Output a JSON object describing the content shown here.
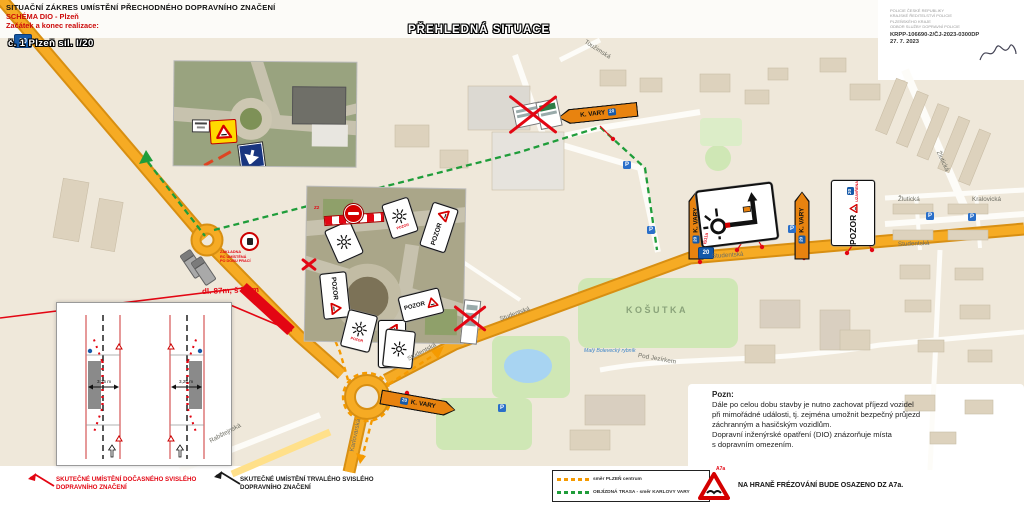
{
  "header": {
    "line1": "SITUAČNÍ ZÁKRES UMÍSTĚNÍ PŘECHODNÉHO DOPRAVNÍHO ZNAČENÍ",
    "line2": "SCHÉMA DIO - Plzeň",
    "line3": "Začátek a konec realizace:",
    "badge": "č. 1 Plzeň sil. I/20"
  },
  "title": "PŘEHLEDNÁ SITUACE",
  "stamp": {
    "l1": "POLICIE ČESKÉ REPUBLIKY",
    "l2": "KRAJSKÉ ŘEDITELSTVÍ POLICIE",
    "l3": "PLZEŇSKÉHO KRAJE",
    "l4": "ODBOR SLUŽBY DOPRAVNÍ POLICIE",
    "ref": "KRPP-106690-2/ČJ-2023-0300DP",
    "date": "27. 7. 2023"
  },
  "note": {
    "title": "Pozn:",
    "line1": "Dále po celou dobu stavby je nutno zachovat příjezd vozidel",
    "line2": "při mimořádné události, tj. zejména umožnit bezpečný průjezd",
    "line3": "záchranným a hasičským vozidlům.",
    "line4": "Dopravní inženýrské opatření (DIO) znázorňuje místa",
    "line5": "s dopravním omezením."
  },
  "legend": {
    "temp_sign": "SKUTEČNÉ UMÍSTĚNÍ DOČASNÉHO SVISLÉHO DOPRAVNÍHO ZNAČENÍ",
    "perm_sign": "SKUTEČNÉ UMÍSTĚNÍ TRVALÉHO SVISLÉHO DOPRAVNÍHO ZNAČENÍ",
    "route_center": "směr PLZEŇ centrum",
    "route_detour": "OBJÍZDNÁ TRASA - směr KARLOVY VARY",
    "a7a_label": "A7a",
    "a7a_text": "NA HRANĚ FRÉZOVÁNÍ BUDE OSAZENO DZ A7a.",
    "colors": {
      "temp": "#e30613",
      "perm": "#1a1a1a",
      "center_route": "#f59a00",
      "detour_route": "#1f9d3a"
    }
  },
  "map": {
    "district": "KOŠUTKA",
    "lake": "Malý Bolevecký rybník",
    "work_zone": "dl. 87m, š 7,4m",
    "base_l1": "ZÁKLADNA",
    "base_l2": "RC UMÍSTĚNÁ",
    "base_l3": "PO DOBU PRACÍ",
    "streets": [
      "Toužimská",
      "Žlutická",
      "Žlutická",
      "Kralovická",
      "Studentská",
      "Studentská",
      "Studentská",
      "Studentská",
      "Pod Jezírkem",
      "Karlovarská",
      "Rabštejnská"
    ],
    "signs": {
      "kvary": "K. VARY",
      "pozor": "POZOR",
      "uzavrena": "UZAVŘENA",
      "z2": "Z2",
      "is11a": "IS11a",
      "shield": "20",
      "parking": "P",
      "lane_width": "3,25 m"
    }
  }
}
